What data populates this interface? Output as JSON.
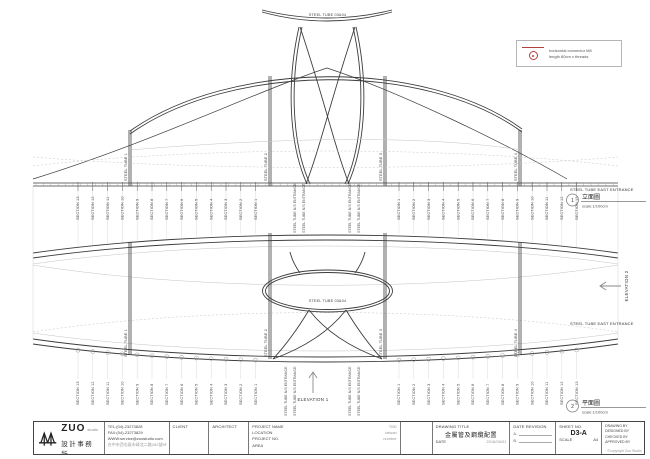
{
  "colors": {
    "line": "#3c3c3c",
    "light": "#c9c9c9",
    "accent_red": "#b4403a"
  },
  "legend": {
    "line1": "horizontal connector M6",
    "line2": "length 80cm x threads"
  },
  "elevation": {
    "top_label": "STEEL TUBE 03&04",
    "post_labels": [
      "STEEL TUBE 1",
      "STEEL TUBE 2",
      "STEEL TUBE 3",
      "STEEL TUBE 4"
    ],
    "entrance_label": "STEEL TUBE N/S ENTRANCE",
    "east_entrance_label": "STEEL TUBE EAST ENTRANCE",
    "elevation1_label": "ELEVATION 1",
    "elevation2_label": "ELEVATION 2"
  },
  "plan": {
    "center_label": "STEEL TUBE 03&04"
  },
  "views": [
    {
      "number": "1",
      "title": "立面圖",
      "scale": "scale:1/100cm"
    },
    {
      "number": "2",
      "title": "平面圖",
      "scale": "scale:1/100cm"
    }
  ],
  "sections": {
    "left": [
      "SECTION 13",
      "SECTION 12",
      "SECTION 11",
      "SECTION 10",
      "SECTION 9",
      "SECTION 8",
      "SECTION 7",
      "SECTION 6",
      "SECTION 5",
      "SECTION 4",
      "SECTION 3",
      "SECTION 2",
      "SECTION 1"
    ],
    "right": [
      "SECTION 1",
      "SECTION 2",
      "SECTION 3",
      "SECTION 4",
      "SECTION 5",
      "SECTION 6",
      "SECTION 7",
      "SECTION 8",
      "SECTION 9",
      "SECTION 10",
      "SECTION 11",
      "SECTION 12",
      "SECTION 13"
    ]
  },
  "titleblock": {
    "logo": {
      "name": "ZUO",
      "sub": "studio",
      "zh": "設計事務所"
    },
    "contact": {
      "tel": "TEL:(04)-23273828",
      "fax": "FAX:(04)-23273829",
      "web": "WWW:service@zuostudio.com",
      "address": "台中市西屯區市政北二路282號5F"
    },
    "client_label": "CLIENT",
    "architect_label": "ARCHITECT",
    "project": {
      "name_label": "PROJECT NAME",
      "name_value": "TBD",
      "location_label": "LOCATION",
      "location_value": "taiwan",
      "no_label": "PROJECT NO.",
      "no_value": "number",
      "area_label": "AREA",
      "area_value": ""
    },
    "drawing": {
      "title_label": "DRAWING TITLE",
      "title_value": "金屬管及鋼纜配置",
      "date_label": "DATE",
      "date_value": "2018/06/01"
    },
    "revision": {
      "label": "DATE REVISION",
      "rows": [
        "A.",
        "B."
      ]
    },
    "sheet": {
      "label": "SHEET NO.",
      "value": "D3-A",
      "scale_label": "SCALE",
      "size": "A4"
    },
    "signoff": {
      "rows": [
        "DRAWING BY",
        "DESIGNED BY",
        "CHECKED BY",
        "APPROVED BY"
      ],
      "copyright": "©copyright Zuo Studio"
    }
  }
}
